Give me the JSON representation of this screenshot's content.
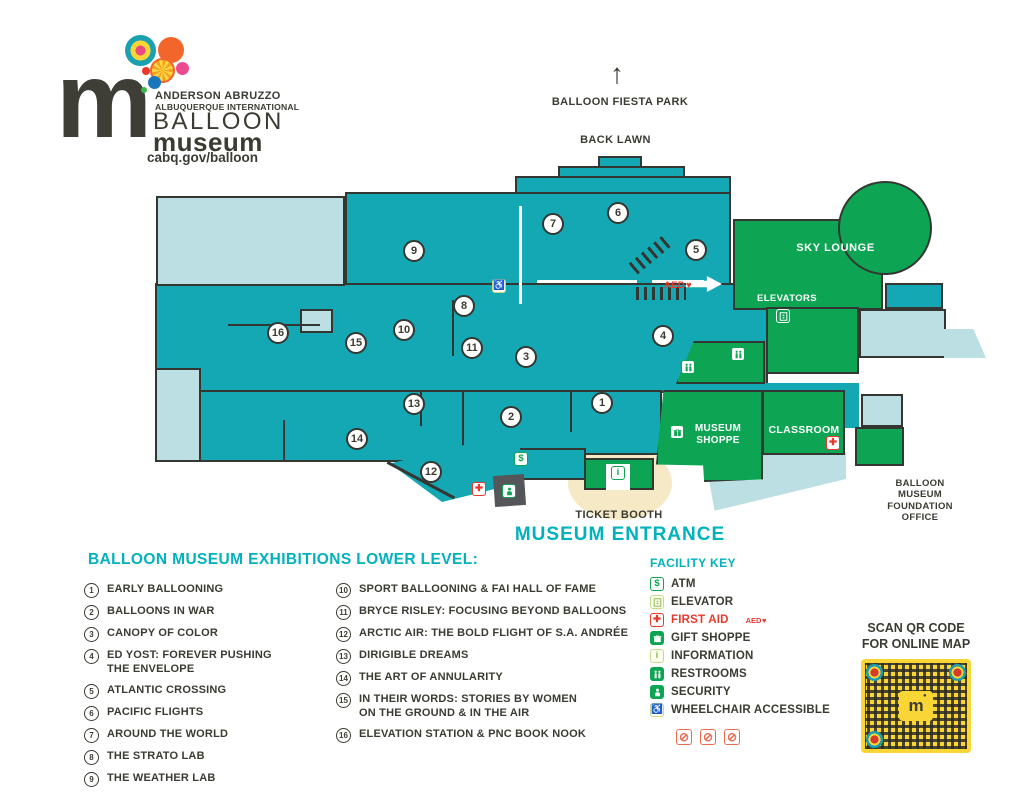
{
  "logo": {
    "org_line1": "ANDERSON ABRUZZO",
    "org_line2": "ALBUQUERQUE INTERNATIONAL",
    "name_line1": "BALLOON",
    "name_line2": "museum",
    "url": "cabq.gov/balloon",
    "mark": "m"
  },
  "map": {
    "labels": {
      "fiesta_park": "BALLOON FIESTA PARK",
      "back_lawn": "BACK LAWN",
      "sky_lounge": "SKY LOUNGE",
      "elevators": "ELEVATORS",
      "museum_shoppe": "MUSEUM\nSHOPPE",
      "classroom": "CLASSROOM",
      "ticket_booth": "TICKET BOOTH",
      "museum_entrance": "MUSEUM ENTRANCE",
      "foundation_office": "BALLOON\nMUSEUM\nFOUNDATION\nOFFICE",
      "aed": "AED"
    },
    "markers": [
      {
        "n": "1",
        "x": 602,
        "y": 403
      },
      {
        "n": "2",
        "x": 511,
        "y": 417
      },
      {
        "n": "3",
        "x": 526,
        "y": 357
      },
      {
        "n": "4",
        "x": 663,
        "y": 336
      },
      {
        "n": "5",
        "x": 696,
        "y": 250
      },
      {
        "n": "6",
        "x": 618,
        "y": 213
      },
      {
        "n": "7",
        "x": 553,
        "y": 224
      },
      {
        "n": "8",
        "x": 464,
        "y": 306
      },
      {
        "n": "9",
        "x": 414,
        "y": 251
      },
      {
        "n": "10",
        "x": 404,
        "y": 330
      },
      {
        "n": "11",
        "x": 472,
        "y": 348
      },
      {
        "n": "12",
        "x": 431,
        "y": 472
      },
      {
        "n": "13",
        "x": 414,
        "y": 404
      },
      {
        "n": "14",
        "x": 357,
        "y": 439
      },
      {
        "n": "15",
        "x": 356,
        "y": 343
      },
      {
        "n": "16",
        "x": 278,
        "y": 333
      }
    ],
    "icons": [
      {
        "icon": "wheelchair",
        "x": 499,
        "y": 286
      },
      {
        "icon": "restrooms",
        "x": 688,
        "y": 367
      },
      {
        "icon": "restrooms",
        "x": 738,
        "y": 354
      },
      {
        "icon": "elevator",
        "x": 783,
        "y": 316
      },
      {
        "icon": "gift",
        "x": 677,
        "y": 432
      },
      {
        "icon": "first-aid",
        "x": 479,
        "y": 489
      },
      {
        "icon": "first-aid",
        "x": 833,
        "y": 443
      },
      {
        "icon": "security",
        "x": 509,
        "y": 491
      },
      {
        "icon": "atm",
        "x": 521,
        "y": 459
      },
      {
        "icon": "information",
        "x": 618,
        "y": 473
      }
    ]
  },
  "exhibitions": {
    "title": "BALLOON MUSEUM EXHIBITIONS LOWER LEVEL:",
    "col1": [
      {
        "num": "1",
        "name": "EARLY BALLOONING"
      },
      {
        "num": "2",
        "name": "BALLOONS IN WAR"
      },
      {
        "num": "3",
        "name": "CANOPY OF COLOR"
      },
      {
        "num": "4",
        "name": "ED YOST: FOREVER PUSHING\nTHE ENVELOPE"
      },
      {
        "num": "5",
        "name": "ATLANTIC CROSSING"
      },
      {
        "num": "6",
        "name": "PACIFIC FLIGHTS"
      },
      {
        "num": "7",
        "name": "AROUND THE WORLD"
      },
      {
        "num": "8",
        "name": "THE STRATO LAB"
      },
      {
        "num": "9",
        "name": "THE WEATHER LAB"
      }
    ],
    "col2": [
      {
        "num": "10",
        "name": "SPORT BALLOONING & FAI HALL OF FAME"
      },
      {
        "num": "11",
        "name": "BRYCE RISLEY: FOCUSING BEYOND BALLOONS"
      },
      {
        "num": "12",
        "name": "ARCTIC AIR: THE BOLD FLIGHT OF S.A. ANDRÉE"
      },
      {
        "num": "13",
        "name": "DIRIGIBLE DREAMS"
      },
      {
        "num": "14",
        "name": "THE ART OF ANNULARITY"
      },
      {
        "num": "15",
        "name": "IN THEIR WORDS: STORIES BY WOMEN\nON THE GROUND & IN THE AIR"
      },
      {
        "num": "16",
        "name": "ELEVATION STATION & PNC BOOK NOOK"
      }
    ]
  },
  "facility_key": {
    "title": "FACILITY KEY",
    "items": [
      {
        "icon": "atm",
        "label": "ATM"
      },
      {
        "icon": "elevator",
        "label": "ELEVATOR"
      },
      {
        "icon": "first-aid",
        "label": "FIRST AID",
        "label_red": true,
        "note": "AED"
      },
      {
        "icon": "gift",
        "label": "GIFT SHOPPE"
      },
      {
        "icon": "information",
        "label": "INFORMATION"
      },
      {
        "icon": "restrooms",
        "label": "RESTROOMS"
      },
      {
        "icon": "security",
        "label": "SECURITY"
      },
      {
        "icon": "wheelchair",
        "label": "WHEELCHAIR ACCESSIBLE"
      }
    ],
    "prohibited": [
      "no-smoking-icon",
      "no-food-icon",
      "no-drinks-icon"
    ]
  },
  "qr": {
    "caption": "SCAN QR CODE\nFOR ONLINE MAP",
    "center_mark": "m"
  },
  "colors": {
    "teal": "#14a8b4",
    "light_blue": "#bcdfe3",
    "green": "#0da553",
    "light_green": "#8bba4e",
    "red": "#e8392c",
    "yellow": "#f9d636",
    "dark_text": "#3b3b32",
    "teal_text": "#00b2bc"
  }
}
